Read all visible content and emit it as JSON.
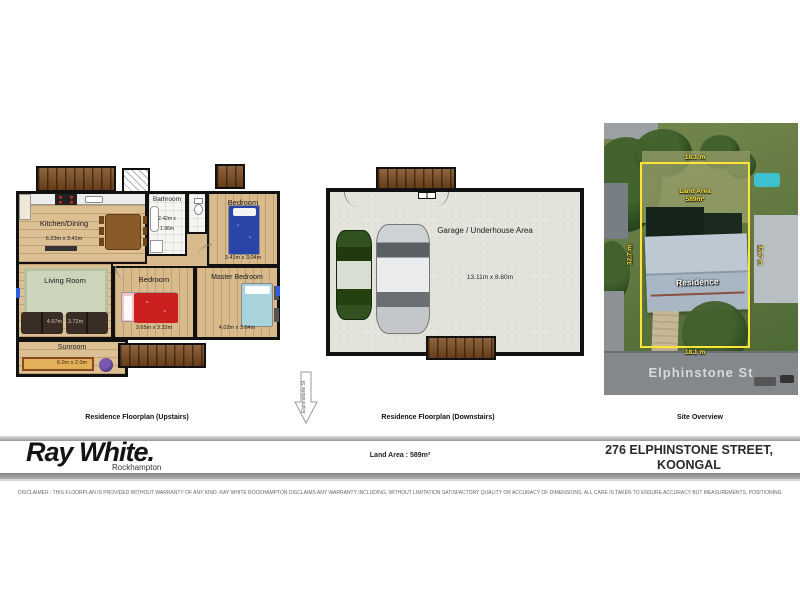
{
  "captions": {
    "upstairs": "Residence Floorplan (Upstairs)",
    "downstairs": "Residence Floorplan (Downstairs)",
    "site": "Site Overview"
  },
  "upstairs": {
    "kitchen_label": "Kitchen/Dining",
    "kitchen_dims": "6.23m x 3.41m",
    "bathroom_label": "Bathroom",
    "bathroom_dims_l1": "2.42m x",
    "bathroom_dims_l2": "1.96m",
    "bedroom1_label": "Bedroom",
    "bedroom1_dims": "3.41m x 3.04m",
    "living_label": "Living Room",
    "living_dims": "4.97m x 3.72m",
    "bedroom2_label": "Bedroom",
    "bedroom2_dims": "3.65m x 3.33m",
    "master_label": "Master Bedroom",
    "master_dims": "4.02m x 3.64m",
    "sunroom_label": "Sunroom",
    "sunroom_dims": "6.0m x 2.0m"
  },
  "downstairs": {
    "garage_label": "Garage / Underhouse Area",
    "garage_dims": "13.11m x 8.60m"
  },
  "site": {
    "land_area_l1": "Land Area",
    "land_area_l2": "589m²",
    "residence": "Residence",
    "street": "Elphinstone St",
    "dim_top": "18.1 m",
    "dim_bottom": "18.1 m",
    "dim_left": "32.7 m",
    "dim_right": "32.7 m"
  },
  "street_arrow": "Elphinstone St",
  "footer": {
    "brand": "Ray White.",
    "office": "Rockhampton",
    "land_area": "Land Area : 589m²",
    "address_l1": "276 ELPHINSTONE STREET,",
    "address_l2": "KOONGAL"
  },
  "disclaimer": "DISCLAIMER : THIS FLOORPLAN IS PROVIDED WITHOUT WARRANTY OF ANY KIND. RAY WHITE ROCKHAMPTON DISCLAIMS ANY WARRANTY INCLUDING, WITHOUT LIMITATION SATISFACTORY QUALITY OR ACCURACY OF DIMENSIONS. ALL CARE IS TAKEN TO ENSURE ACCURACY BUT MEASUREMENTS, POSITIONING AND PLACEMENTS CANNOT BE GUARANTEED. SITEPLAN MARKINGS ARE INDICATORS ONLY AND NOT INTENDED TO REPLACE SURVEY PLANS.",
  "colors": {
    "brand_black": "#141414",
    "boundary_yellow": "#ffe23a",
    "deck_brown": "#7c4a1e",
    "wood_floor": "#dcc094"
  }
}
